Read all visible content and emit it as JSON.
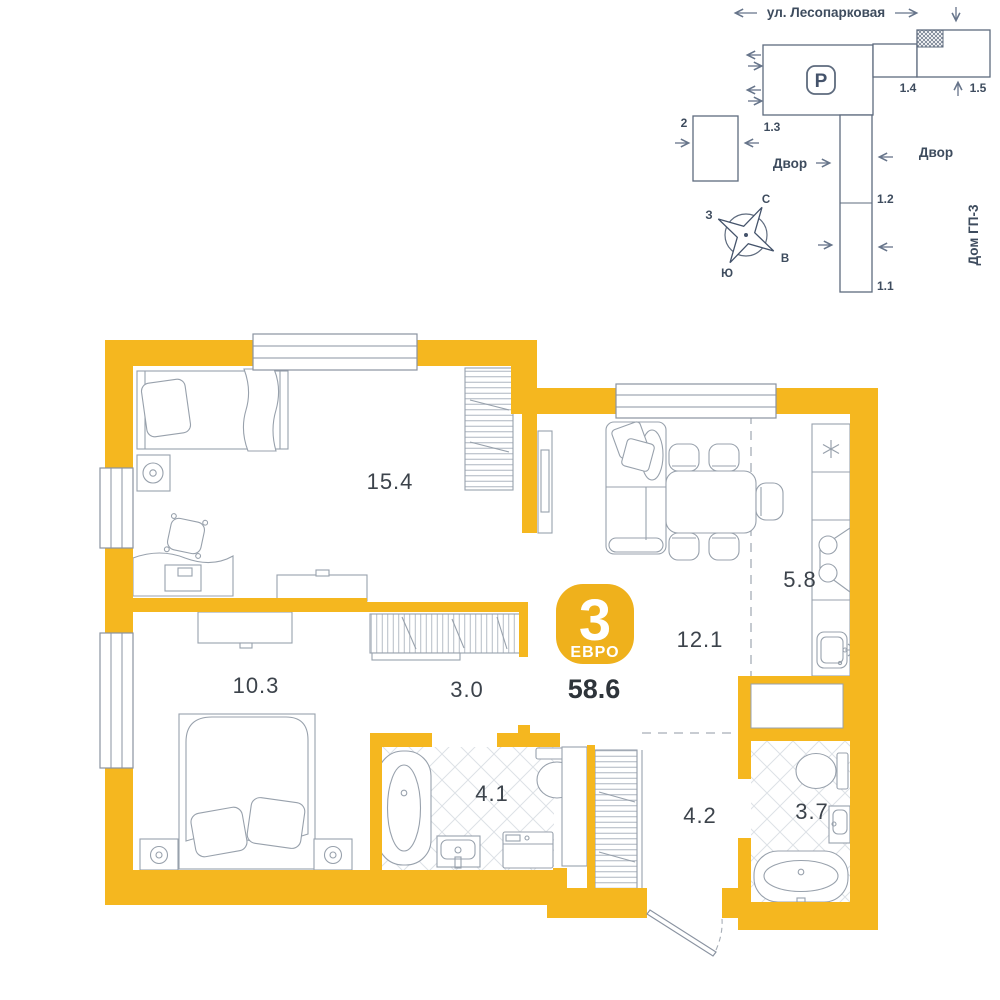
{
  "site_plan": {
    "street": "ул. Лесопарковая",
    "parking_label": "P",
    "yard_left": "Двор",
    "yard_right": "Двор",
    "house_label": "Дом ГП-3",
    "buildings": {
      "b2": "2",
      "b13": "1.3",
      "b14": "1.4",
      "b15": "1.5",
      "b12": "1.2",
      "b11": "1.1"
    },
    "compass": {
      "n": "С",
      "s": "Ю",
      "w": "З",
      "e": "В"
    }
  },
  "apartment": {
    "badge_rooms": "3",
    "badge_type": "ЕВРО",
    "total_area": "58.6",
    "rooms": [
      {
        "name": "bedroom-1",
        "area": "15.4"
      },
      {
        "name": "bedroom-2",
        "area": "10.3"
      },
      {
        "name": "hallway",
        "area": "3.0"
      },
      {
        "name": "living-dining",
        "area": "12.1"
      },
      {
        "name": "kitchen",
        "area": "5.8"
      },
      {
        "name": "bathroom-1",
        "area": "4.1"
      },
      {
        "name": "entry-hall",
        "area": "4.2"
      },
      {
        "name": "bathroom-2",
        "area": "3.7"
      }
    ]
  },
  "colors": {
    "wall": "#F5B71F",
    "badge": "#EFB11C",
    "furniture_line": "#98A1AC",
    "site_line": "#66748A",
    "label": "#3C434B"
  }
}
